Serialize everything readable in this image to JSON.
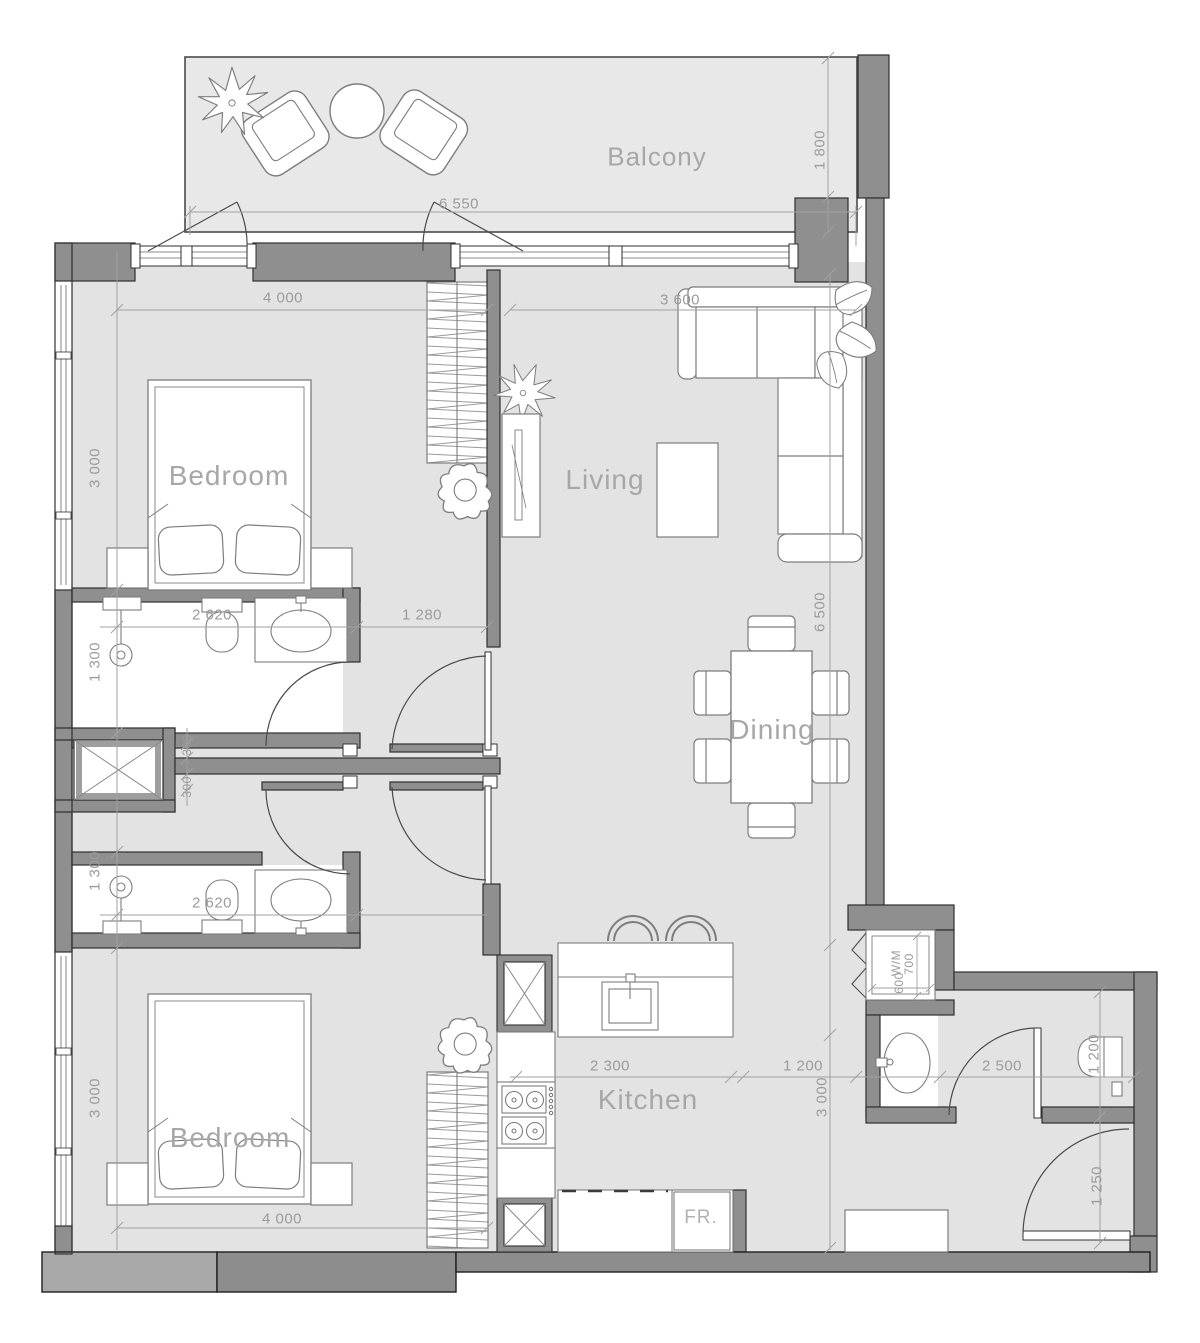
{
  "colors": {
    "floor": "#e3e3e3",
    "balcony_floor": "#e8e8e8",
    "wall": "#8f8f8f",
    "wall_light": "#a9a9a9",
    "outline": "#2f2f2f",
    "furniture_line": "#7d7d7d",
    "dimension_text": "#9b9b9b",
    "label_text": "#a7a7a7"
  },
  "rooms": {
    "balcony": "Balcony",
    "bedroom_top": "Bedroom",
    "living": "Living",
    "dining": "Dining",
    "kitchen": "Kitchen",
    "bedroom_bottom": "Bedroom"
  },
  "appliances": {
    "fridge": "FR.",
    "washer": "W/M"
  },
  "dimensions": {
    "balcony_width": "6 550",
    "balcony_depth": "1 800",
    "bedroom_top_width": "4 000",
    "living_width": "3 600",
    "bedroom_top_depth": "3 000",
    "living_length": "6 500",
    "bath_top_width": "2 620",
    "hall_opening": "1 280",
    "bath_top_depth": "1 300",
    "wall_offset_top": "300",
    "wall_offset_bottom": "300",
    "bath_bottom_depth": "1 300",
    "bath_bottom_width": "2 620",
    "bedroom_bottom_depth": "3 000",
    "bedroom_bottom_width": "4 000",
    "kitchen_width": "2 300",
    "kitchen_passage": "1 200",
    "kitchen_depth": "3 000",
    "entry_width": "2 500",
    "wc_depth": "1 200",
    "entry_depth": "1 250",
    "washer_depth": "700",
    "washer_width": "600"
  }
}
